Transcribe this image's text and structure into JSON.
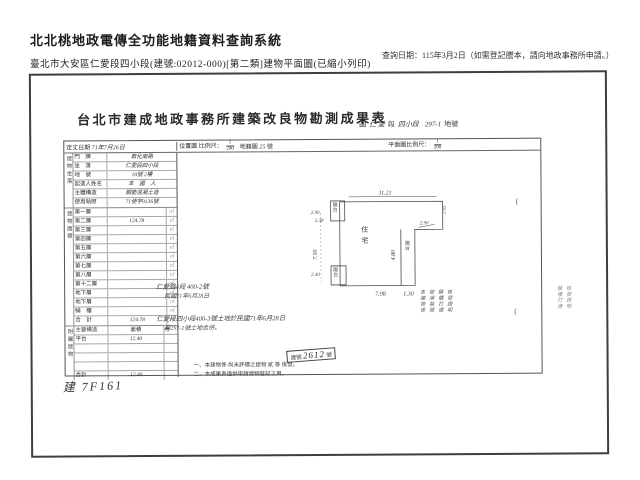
{
  "header": {
    "system_title": "北北桃地政電傳全功能地籍資料查詢系統",
    "query_date": "查詢日期：115年3月2日（如需登記謄本，請向地政事務所申請。）",
    "doc_line": "臺北市大安區仁愛段四小段(建號:02012-000)[第二類]建物平面圖(已縮小列印)"
  },
  "form": {
    "title": "台北市建成地政事務所建築改良物勘測成果表",
    "location_items": [
      {
        "t": "圖",
        "h": false
      },
      {
        "t": "仁 愛",
        "h": true
      },
      {
        "t": "段",
        "h": false
      },
      {
        "t": "四小段",
        "h": true
      },
      {
        "t": "297-1",
        "h": true
      },
      {
        "t": "地號",
        "h": false
      }
    ],
    "scale_row": {
      "survey_date_label": "定丈日期",
      "survey_date": "71年7月26日",
      "loc_map": "位置圖 比例尺：",
      "loc_num": "1",
      "loc_den": "240",
      "cad_label": "地籍圖",
      "cad_no": "25",
      "cad_suffix": "號",
      "plan_label": "平面圖比例尺：",
      "plan_num": "1",
      "plan_den": "200"
    },
    "info_group_label": "建物坐落",
    "info_rows": [
      {
        "label": "門　牌",
        "value": "敦化南路"
      },
      {
        "label": "坐　落",
        "value": "仁愛段四小段"
      },
      {
        "label": "地　號",
        "value": "10號 2樓"
      },
      {
        "label": "起造人姓名",
        "value": "本　國　人"
      },
      {
        "label": "主體構造",
        "value": "鋼筋混凝土造"
      },
      {
        "label": "使用執照",
        "value": "71使字0136號"
      }
    ],
    "area_group_label": "建物面積",
    "area_unit": "㎡",
    "area_rows": [
      {
        "label": "第一層",
        "value": ""
      },
      {
        "label": "第二層",
        "value": "124.78"
      },
      {
        "label": "第三層",
        "value": ""
      },
      {
        "label": "第四層",
        "value": ""
      },
      {
        "label": "第五層",
        "value": ""
      },
      {
        "label": "第六層",
        "value": ""
      },
      {
        "label": "第七層",
        "value": ""
      },
      {
        "label": "第八層",
        "value": ""
      },
      {
        "label": "第十二層",
        "value": ""
      },
      {
        "label": "地下層",
        "value": ""
      },
      {
        "label": "地下層",
        "value": ""
      },
      {
        "label": "騎　樓",
        "value": ""
      },
      {
        "label": "合　計",
        "value": "124.78"
      }
    ],
    "annex_group_label": "附屬建物",
    "annex_header": [
      "主要構造",
      "面積",
      "考"
    ],
    "annex_rows": [
      {
        "c1": "平台",
        "c2": "12.40",
        "c3": ""
      },
      {
        "c1": "",
        "c2": "",
        "c3": ""
      },
      {
        "c1": "",
        "c2": "",
        "c3": ""
      },
      {
        "c1": "",
        "c2": "",
        "c3": ""
      },
      {
        "c1": "合計",
        "c2": "12.40",
        "c3": ""
      }
    ]
  },
  "annotations": {
    "hand_a1": "仁愛路4段 400-2號",
    "hand_a2": "民國71年6月28日",
    "hand_b1": "仁愛段四小段400-3號土地於民國71年6月28日",
    "hand_b2": "與297-1號土地合併。",
    "vertical_cols": [
      "本建物係",
      "使用執照",
      "騎樓打通",
      "核發證明"
    ],
    "right_vertical_cols": [
      "騎樓打通",
      "核發證明"
    ],
    "building_no_hand": "建 7F161",
    "paren_mark": "("
  },
  "stamp": {
    "label": "建號",
    "value": "2612",
    "suffix": "號"
  },
  "notes": [
    "一、本建物係 尚未評價之建物 貳 等 俟發。",
    "二、本成果表僅供申請建物登記之用。"
  ],
  "plan": {
    "dims": {
      "top": "11.21",
      "left": "7.50",
      "bottom": "7.98",
      "strip_left": "4.80",
      "strip_bottom": "1.30",
      "notch_a": "2.90",
      "notch_b": "1.65",
      "tl_w": "2.90",
      "tl_h": "2.38",
      "bl_w": "2.40"
    },
    "labels": {
      "balcony": "陽台",
      "interior": "住宅"
    }
  }
}
